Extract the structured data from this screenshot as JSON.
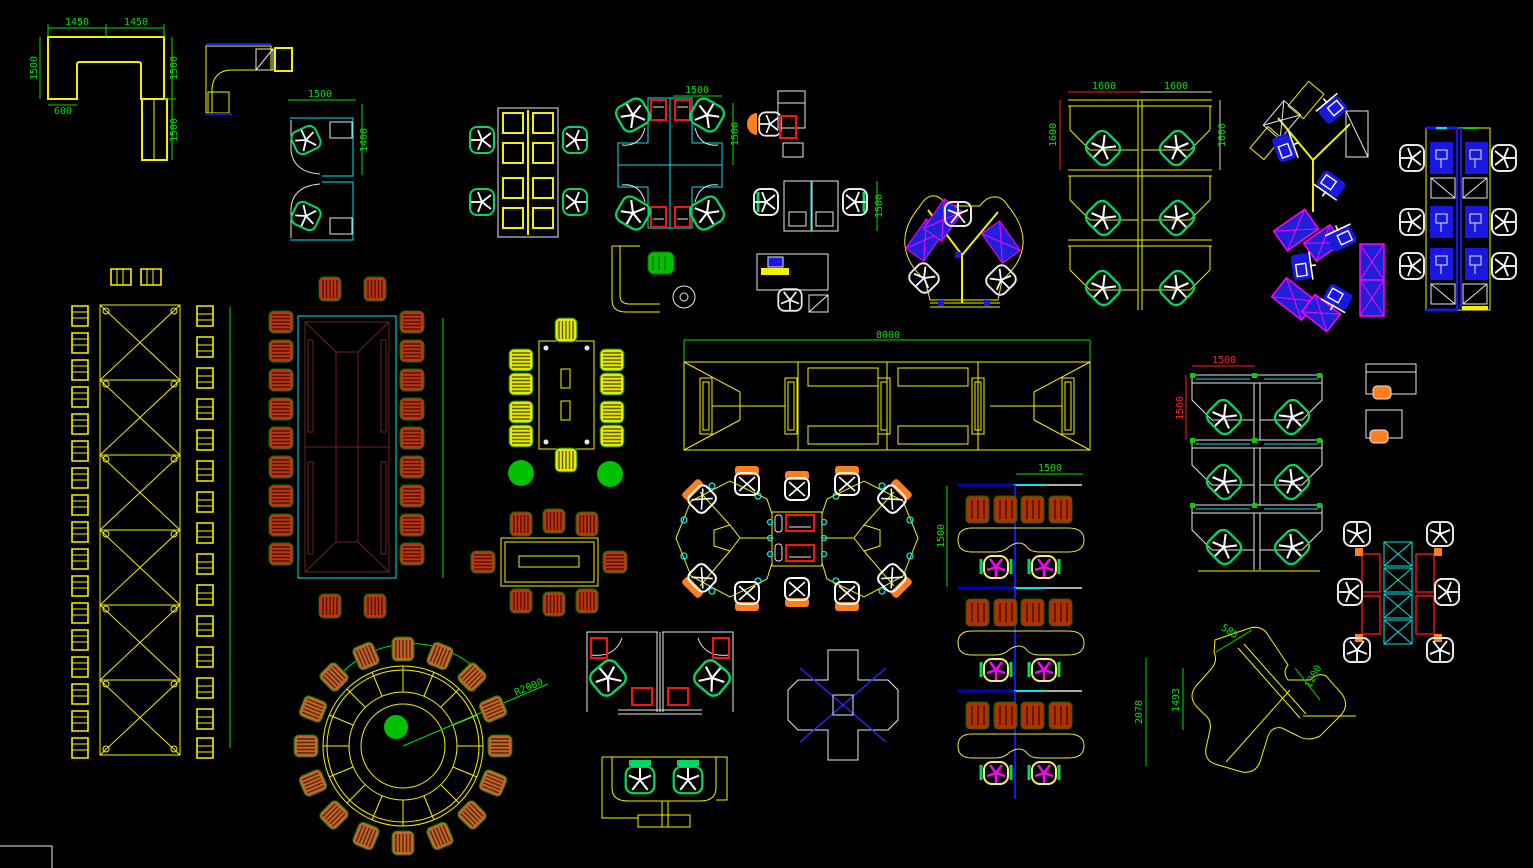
{
  "app": {
    "type": "cad-model-space",
    "content": "office furniture plan-view block library",
    "background": "#000000"
  },
  "palette": {
    "line_yellow": "#f2f200",
    "dim_green": "#00e000",
    "dim_red": "#ff2020",
    "cyan": "#00e8e8",
    "blue": "#1818e0",
    "magenta": "#ff00ff",
    "white": "#e8e8e8",
    "chair_orange": "#c03510",
    "cabinet_orange": "#b03000",
    "seat_green": "#00d860",
    "plant_green": "#00c000",
    "table_maroon": "#6a2424",
    "accent_orange": "#ff7f1e"
  },
  "dimensions": [
    {
      "text": "1450",
      "color": "#00e000"
    },
    {
      "text": "1450",
      "color": "#00e000"
    },
    {
      "text": "1500",
      "color": "#00e000"
    },
    {
      "text": "600",
      "color": "#00e000"
    },
    {
      "text": "1500",
      "color": "#00e000"
    },
    {
      "text": "1500",
      "color": "#00e000"
    },
    {
      "text": "1500",
      "color": "#00e000"
    },
    {
      "text": "1400",
      "color": "#00e000"
    },
    {
      "text": "1500",
      "color": "#00e000"
    },
    {
      "text": "1500",
      "color": "#00e000"
    },
    {
      "text": "1500",
      "color": "#00e000"
    },
    {
      "text": "1600",
      "color": "#00e000"
    },
    {
      "text": "1600",
      "color": "#00e000"
    },
    {
      "text": "1600",
      "color": "#00e000"
    },
    {
      "text": "1600",
      "color": "#00e000"
    },
    {
      "text": "8000",
      "color": "#00e000"
    },
    {
      "text": "1500",
      "color": "#ff2020"
    },
    {
      "text": "1500",
      "color": "#ff2020"
    },
    {
      "text": "1500",
      "color": "#00e000"
    },
    {
      "text": "1500",
      "color": "#00e000"
    },
    {
      "text": "R2000",
      "color": "#00e000"
    },
    {
      "text": "585",
      "color": "#00e000"
    },
    {
      "text": "1200",
      "color": "#00e000"
    },
    {
      "text": "2078",
      "color": "#00e000"
    },
    {
      "text": "1493",
      "color": "#00e000"
    }
  ]
}
